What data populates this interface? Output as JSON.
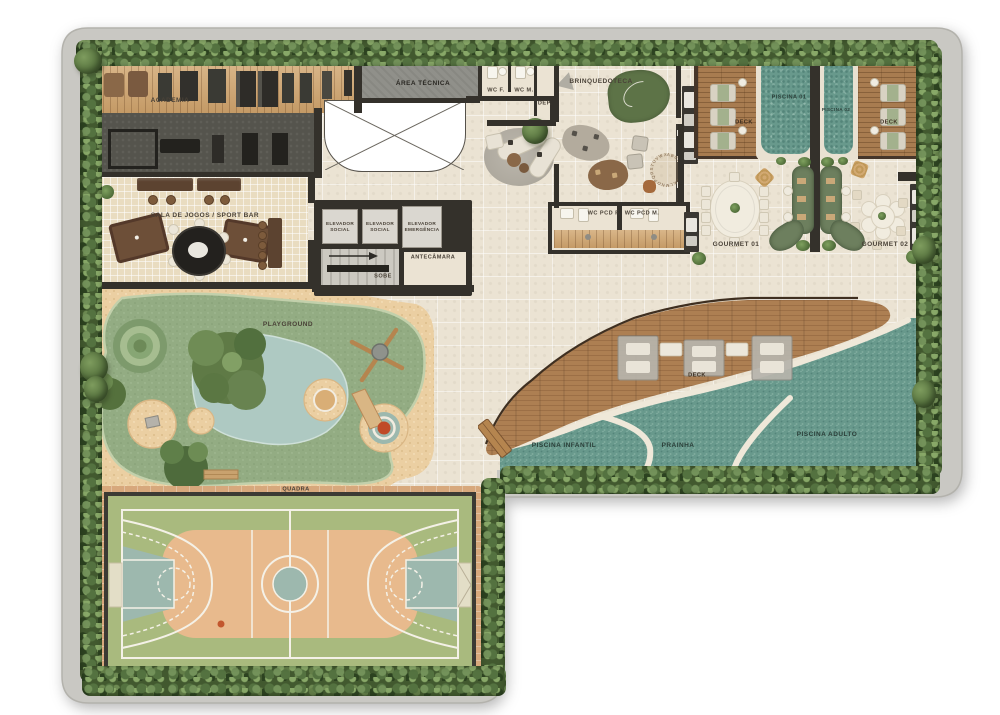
{
  "plan_title": "amenities-floor-plan",
  "labels": {
    "academia": "ACADEMIA",
    "area_tecnica": "ÁREA TÉCNICA",
    "wc_f": "WC F.",
    "wc_m": "WC M.",
    "dep": "DEP.",
    "brinquedoteca": "BRINQUEDOTECA",
    "piscina_01": "PISCINA 01",
    "piscina_02": "PISCINA 02",
    "deck": "DECK",
    "gourmet_01": "GOURMET 01",
    "gourmet_02": "GOURMET 02",
    "sala_de_jogos": "SALA DE JOGOS / SPORT BAR",
    "elevador_social": "ELEVADOR SOCIAL",
    "elevador_emergencia": "ELEVADOR EMERGÊNCIA",
    "antecamara": "ANTECÂMARA",
    "sobe": "SOBE",
    "wc_pcd_f": "WC PCD F.",
    "wc_pcd_m": "WC PCD M.",
    "playground": "PLAYGROUND",
    "quadra": "QUADRA",
    "piscina_infantil": "PISCINA INFANTIL",
    "prainha": "PRAINHA",
    "piscina_adulto": "PISCINA ADULTO",
    "alphabet": "ABCDEFGHIJKLMNOPQRSTUVWXYZ"
  },
  "colors": {
    "slab": "#c9c8c3",
    "floor": "#ebe3d3",
    "wall": "#34312b",
    "hedge": "#42592f",
    "water": "#68998c",
    "deck_wood": "#a87c50",
    "gym_wood": "#d9b689",
    "gym_rubber": "#55544d",
    "sand": "#ebcfa2",
    "playground_green": "#93ac83",
    "pond": "#aec9c2",
    "court_green": "#a9ba7e",
    "court_orange": "#e8ba8d",
    "court_teal": "#9db8ae",
    "paving": "#d7a87c",
    "sofa_green": "#6d7f5e",
    "play_mat_green": "#5d7347"
  }
}
